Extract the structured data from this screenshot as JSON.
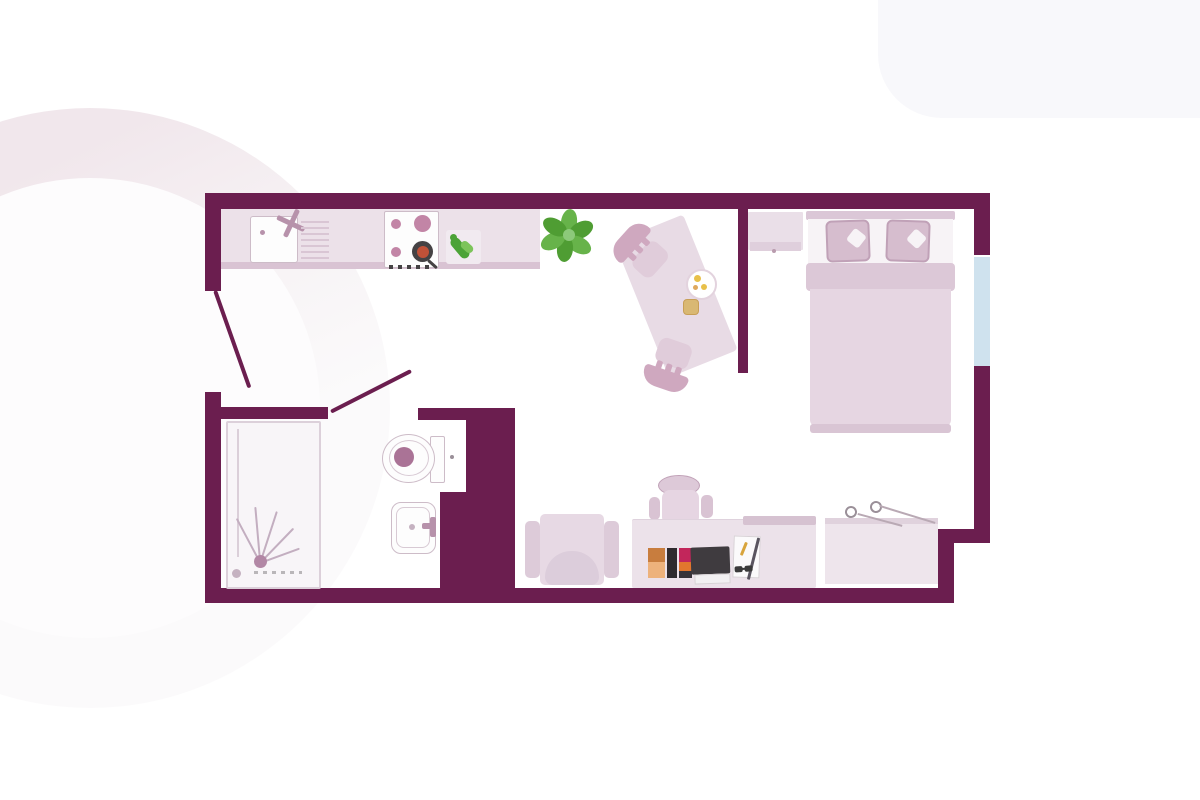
{
  "image": {
    "kind": "floor-plan",
    "description": "studio apartment top-down floor plan",
    "fixtures": [
      "entrance-door",
      "kitchen-counter",
      "kitchen-sink",
      "kitchen-faucet",
      "dish-drainer",
      "stove",
      "frying-pan",
      "cutting-board",
      "potted-plant",
      "dining-table",
      "dining-chair",
      "plate",
      "cup",
      "partition-wall",
      "nightstand",
      "double-bed",
      "pillow",
      "window",
      "bathroom-door",
      "shower",
      "shower-head",
      "toilet",
      "washbasin",
      "armchair",
      "office-chair",
      "desk",
      "laptop",
      "books",
      "notepad",
      "pen",
      "glasses",
      "wardrobe-hangers"
    ]
  },
  "colors": {
    "wall": "#6b1e4f",
    "floor": "#ffffff",
    "door_line": "#6b1e4f",
    "window": "#cfe2ee",
    "counter": "#ece1e9",
    "counter_edge": "#d9c3d3",
    "appliance_white": "#fdfdfd",
    "fixture_border": "#cdbcc8",
    "fixture_inner_border": "#d8cad4",
    "burner": "#c285a6",
    "pan_ring": "#454244",
    "pan_inner": "#c15138",
    "drainer_line": "#d9c6d4",
    "faucet": "#b792ab",
    "cutting_board": "#f1eaf0",
    "veggie_green": "#4ca337",
    "veggie_green_light": "#7cc45a",
    "plant_leaf": "#67b34a",
    "plant_leaf_dark": "#4f9d33",
    "plant_center": "#8cc97a",
    "table": "#e8dbe5",
    "chair_back": "#cfa8bf",
    "chair_seat": "#e0ccda",
    "bed_sheet": "#f7f3f6",
    "bed_headboard": "#dbc7d7",
    "bed_fold": "#dcc8d7",
    "bed_duvet": "#e6d6e2",
    "bed_foot": "#d9c5d4",
    "pillow": "#d6bdce",
    "pillow_border": "#c0a1b7",
    "nightstand": "#eadfe8",
    "nightstand_lip": "#dfcfdc",
    "wardrobe": "#eee5ec",
    "wardrobe_edge": "#e0d2dd",
    "desk": "#ece2ea",
    "desk_shelf": "#d6c2d1",
    "armchair_body": "#e7d9e4",
    "armchair_arm": "#ddcbd9",
    "armchair_cushion": "#dccddb",
    "office_chair_back": "#ddc9d8",
    "office_chair_body": "#e6d5e2",
    "office_chair_arm": "#d9c3d3",
    "laptop": "#3f3b3f",
    "laptop_paper": "#f2f0f2",
    "book_brown": "#c87d3e",
    "book_peach": "#edb27c",
    "book_black": "#2e2a2e",
    "book_pink": "#c2265b",
    "book_orange": "#e2762e",
    "book_dark": "#37333a",
    "notepad": "#fbfafb",
    "notepad_border": "#d8d2d6",
    "pen": "#5a5560",
    "pen_tip": "#d8a43c",
    "glasses": "#3a3a3a",
    "toilet_dot": "#aa7396",
    "shower_tray": "#f8f5f8",
    "shower_border": "#dcd0da",
    "spray_line": "#c3aec0",
    "shower_head": "#b287a5",
    "shower_drain": "#c5b2c1",
    "plate_dot": "#e8c04a",
    "plate_dot2": "#dfa95e",
    "cup": "#d9b873",
    "cup_border": "#c89f57",
    "hanger": "#9a8f98",
    "rail": "#b9a9b4",
    "knob": "#b99cae",
    "bg_circle": "#f7f3f5",
    "bg_circle_pink": "#f1e7ec",
    "bg_inner": "#fdfcfd",
    "bg_topright": "#f8f8fb"
  }
}
